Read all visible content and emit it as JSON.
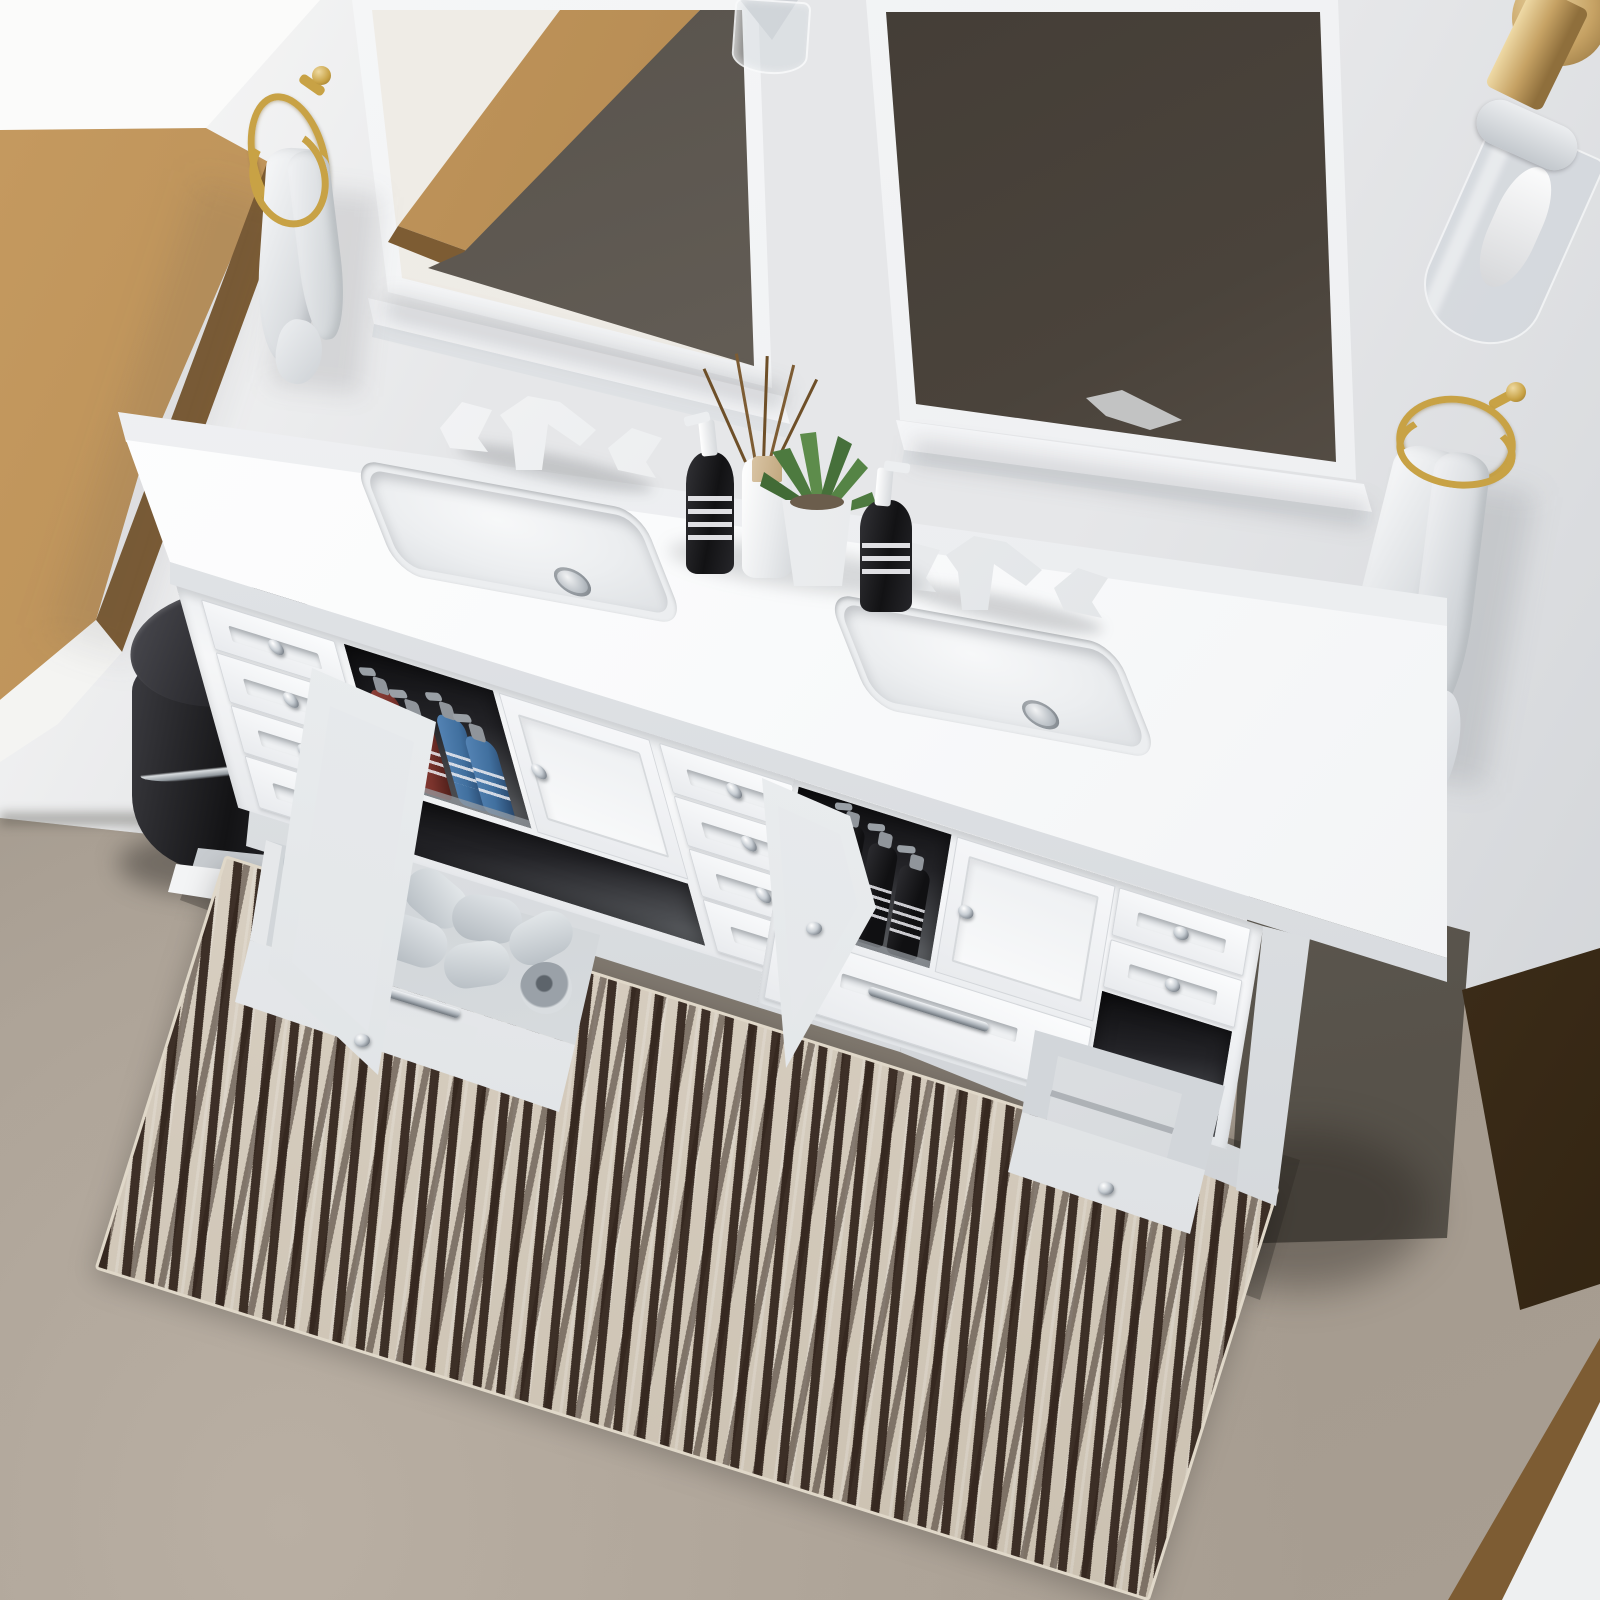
{
  "title": "White double-sink bathroom vanity — overhead 3D product render",
  "scene": {
    "description": "Overhead angled view of a white shaker double-sink bathroom vanity with two white-framed mirrors, oak window frame, brass towel rings and sconce, open drawers and cabinets showing toiletries, toilet paper and towels, black pedal bin, and a cream-and-brown striped runner rug on a concrete floor",
    "room_features": [
      "white walls",
      "oak-framed window",
      "taupe concrete floor",
      "oak door casing bottom-right"
    ]
  },
  "colors": {
    "wall": "#e6e7e9",
    "wallshade": "#cdd0d4",
    "windowlight": "#fbfbfa",
    "wood": "#b1874e",
    "woodlight": "#c59a60",
    "wooddark": "#7d5c33",
    "wooddoor": "#4a3722",
    "floor": "#a2988c",
    "floorlight": "#b9afa3",
    "floorshadow": "#60594f",
    "vanity": "#f6f7f8",
    "vanityshade": "#dadde0",
    "counterwhite": "#f9fafb",
    "mirrorglass": "#ece9e3",
    "mirrordark": "#47413a",
    "gold": "#c8a245",
    "brass": "#c6a264",
    "chrome": "#c9ced3",
    "ink": "#1b1b1d",
    "towel": "#eff0f2",
    "rugbase": "#d8cfc1",
    "rugstripe": "#30221a",
    "paperroll": "#ccd2d7",
    "bottlered": "#7a332c",
    "bottleblue": "#41709f"
  },
  "objects": {
    "mirrors": {
      "count": 2,
      "frame": "white wood with bottom shelf ledge"
    },
    "lighting": {
      "wall_sconce": "brass stem with clear glass cylinder shade",
      "pendant": "clear glass cylinder with chrome cone"
    },
    "hardware": {
      "towel_rings": {
        "count": 2,
        "finish": "brushed gold"
      },
      "knobs": "polished chrome",
      "pulls": "polished chrome bars"
    },
    "vanity": {
      "finish": "matte white shaker",
      "countertop": "white engineered stone with low backsplash",
      "sinks": {
        "count": 2,
        "type": "rectangular undermount",
        "drain": "chrome pop-up"
      },
      "faucets": {
        "count": 2,
        "type": "widespread two-handle",
        "finish": "matte white"
      },
      "storage": {
        "left_drawers": 4,
        "middle_drawers": 4,
        "right_drawers": 3,
        "cabinets": 2,
        "open": {
          "left_cabinet": "red and blue soap pump bottles",
          "right_cabinet": "black pump bottles",
          "left_bottom_drawer": "loose toilet paper rolls",
          "right_side_drawer": "folded white towels"
        }
      }
    },
    "countertop_items": [
      "black pump bottle",
      "white reed diffuser with rattan sticks",
      "potted succulent in white pot",
      "black pump bottle"
    ],
    "accessories": [
      "black pedal trash can with chrome band",
      "two white hand towels on rings",
      "cream and dark-brown striped runner rug",
      "white paper slip on floor"
    ]
  }
}
